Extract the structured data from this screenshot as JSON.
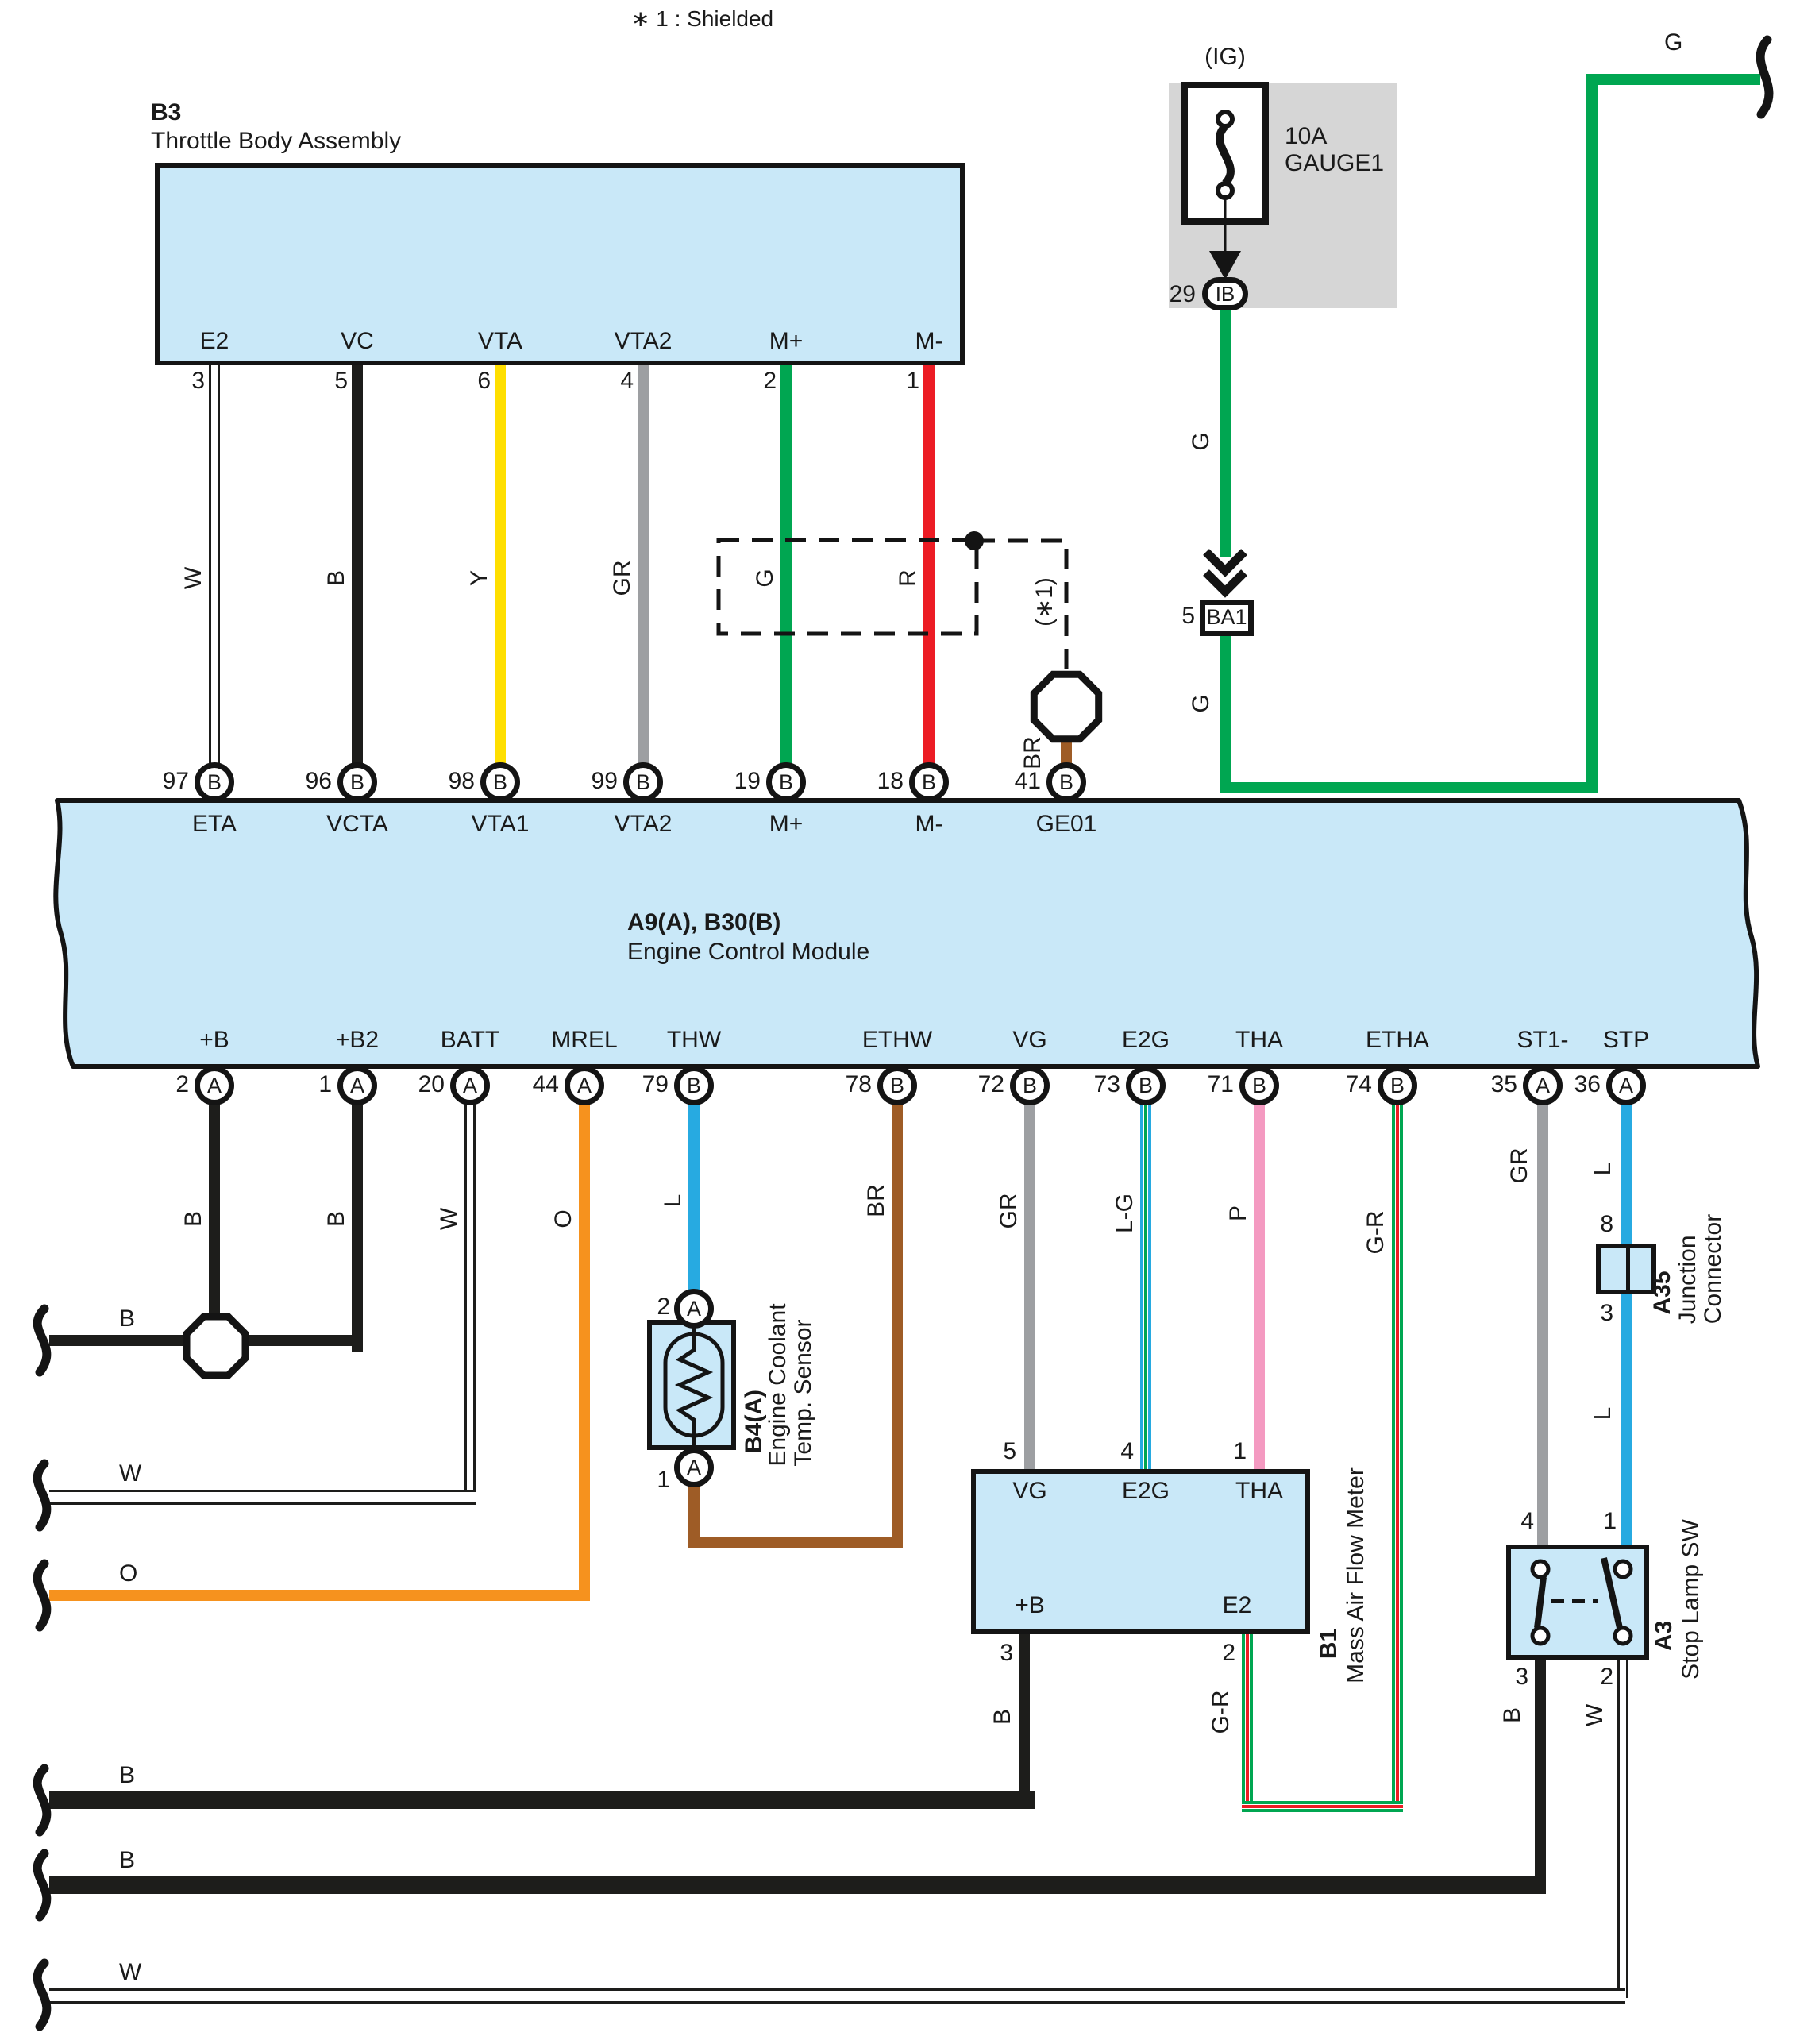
{
  "note": "∗ 1 : Shielded",
  "colors": {
    "box_fill": "#c9e8f8",
    "green": "#00a651",
    "red": "#ec1c24",
    "yellow": "#ffdf00",
    "gray": "#9d9fa2",
    "orange": "#f6921e",
    "blue": "#27aae1",
    "pink": "#f49ac1",
    "brown": "#9e5c26",
    "black": "#1d1d1b",
    "panel": "#d6d6d6"
  },
  "throttle": {
    "code": "B3",
    "title": "Throttle Body Assembly",
    "pin_labels": [
      "E2",
      "VC",
      "VTA",
      "VTA2",
      "M+",
      "M-"
    ],
    "pin_numbers": [
      "3",
      "5",
      "6",
      "4",
      "2",
      "1"
    ],
    "wire_codes": [
      "W",
      "B",
      "Y",
      "GR",
      "G",
      "R"
    ]
  },
  "shield": {
    "ref": "(∗1)",
    "wire_code": "BR"
  },
  "fuse": {
    "source": "(IG)",
    "rating": "10A",
    "name": "GAUGE1",
    "pin_number": "29",
    "pin_label": "IB",
    "wire_code_upper": "G",
    "wire_code_lower": "G",
    "connector_number": "5",
    "connector_label": "BA1",
    "top_wire_code": "G"
  },
  "ecm": {
    "code": "A9(A), B30(B)",
    "title": "Engine Control Module",
    "top_pins": [
      {
        "number": "97",
        "connector": "B",
        "label": "ETA"
      },
      {
        "number": "96",
        "connector": "B",
        "label": "VCTA"
      },
      {
        "number": "98",
        "connector": "B",
        "label": "VTA1"
      },
      {
        "number": "99",
        "connector": "B",
        "label": "VTA2"
      },
      {
        "number": "19",
        "connector": "B",
        "label": "M+"
      },
      {
        "number": "18",
        "connector": "B",
        "label": "M-"
      },
      {
        "number": "41",
        "connector": "B",
        "label": "GE01"
      }
    ],
    "bottom_pins": [
      {
        "number": "2",
        "connector": "A",
        "label": "+B"
      },
      {
        "number": "1",
        "connector": "A",
        "label": "+B2"
      },
      {
        "number": "20",
        "connector": "A",
        "label": "BATT"
      },
      {
        "number": "44",
        "connector": "A",
        "label": "MREL"
      },
      {
        "number": "79",
        "connector": "B",
        "label": "THW"
      },
      {
        "number": "78",
        "connector": "B",
        "label": "ETHW"
      },
      {
        "number": "72",
        "connector": "B",
        "label": "VG"
      },
      {
        "number": "73",
        "connector": "B",
        "label": "E2G"
      },
      {
        "number": "71",
        "connector": "B",
        "label": "THA"
      },
      {
        "number": "74",
        "connector": "B",
        "label": "ETHA"
      },
      {
        "number": "35",
        "connector": "A",
        "label": "ST1-"
      },
      {
        "number": "36",
        "connector": "A",
        "label": "STP"
      }
    ]
  },
  "wires": {
    "plus_b": "B",
    "plus_b2": "B",
    "bus_b0": "B",
    "batt": "W",
    "bus_w0": "W",
    "mrel": "O",
    "bus_o": "O",
    "thw": "L",
    "ethw": "BR",
    "vg": "GR",
    "e2g": "L-G",
    "tha": "P",
    "etha": "G-R",
    "maf_e2": "G-R",
    "st1": "GR",
    "stp_upper": "L",
    "stp_lower": "L",
    "maf_b": "B",
    "bus_b1": "B",
    "stop_b": "B",
    "bus_b2": "B",
    "stop_w": "W",
    "bus_w": "W"
  },
  "coolant_sensor": {
    "code": "B4(A)",
    "name_line1": "Engine Coolant",
    "name_line2": "Temp. Sensor",
    "top_pin": {
      "number": "2",
      "connector": "A"
    },
    "bottom_pin": {
      "number": "1",
      "connector": "A"
    }
  },
  "maf": {
    "code": "B1",
    "title": "Mass Air Flow Meter",
    "top_numbers": [
      "5",
      "4",
      "1"
    ],
    "top_labels": [
      "VG",
      "E2G",
      "THA"
    ],
    "bottom_numbers": [
      "3",
      "2"
    ],
    "bottom_labels": [
      "+B",
      "E2"
    ]
  },
  "junction_connector": {
    "code": "A35",
    "name_line1": "Junction",
    "name_line2": "Connector",
    "top_number": "8",
    "bottom_number": "3"
  },
  "stop_lamp": {
    "code": "A3",
    "title": "Stop Lamp SW",
    "top_numbers": [
      "4",
      "1"
    ],
    "bottom_numbers": [
      "3",
      "2"
    ]
  }
}
